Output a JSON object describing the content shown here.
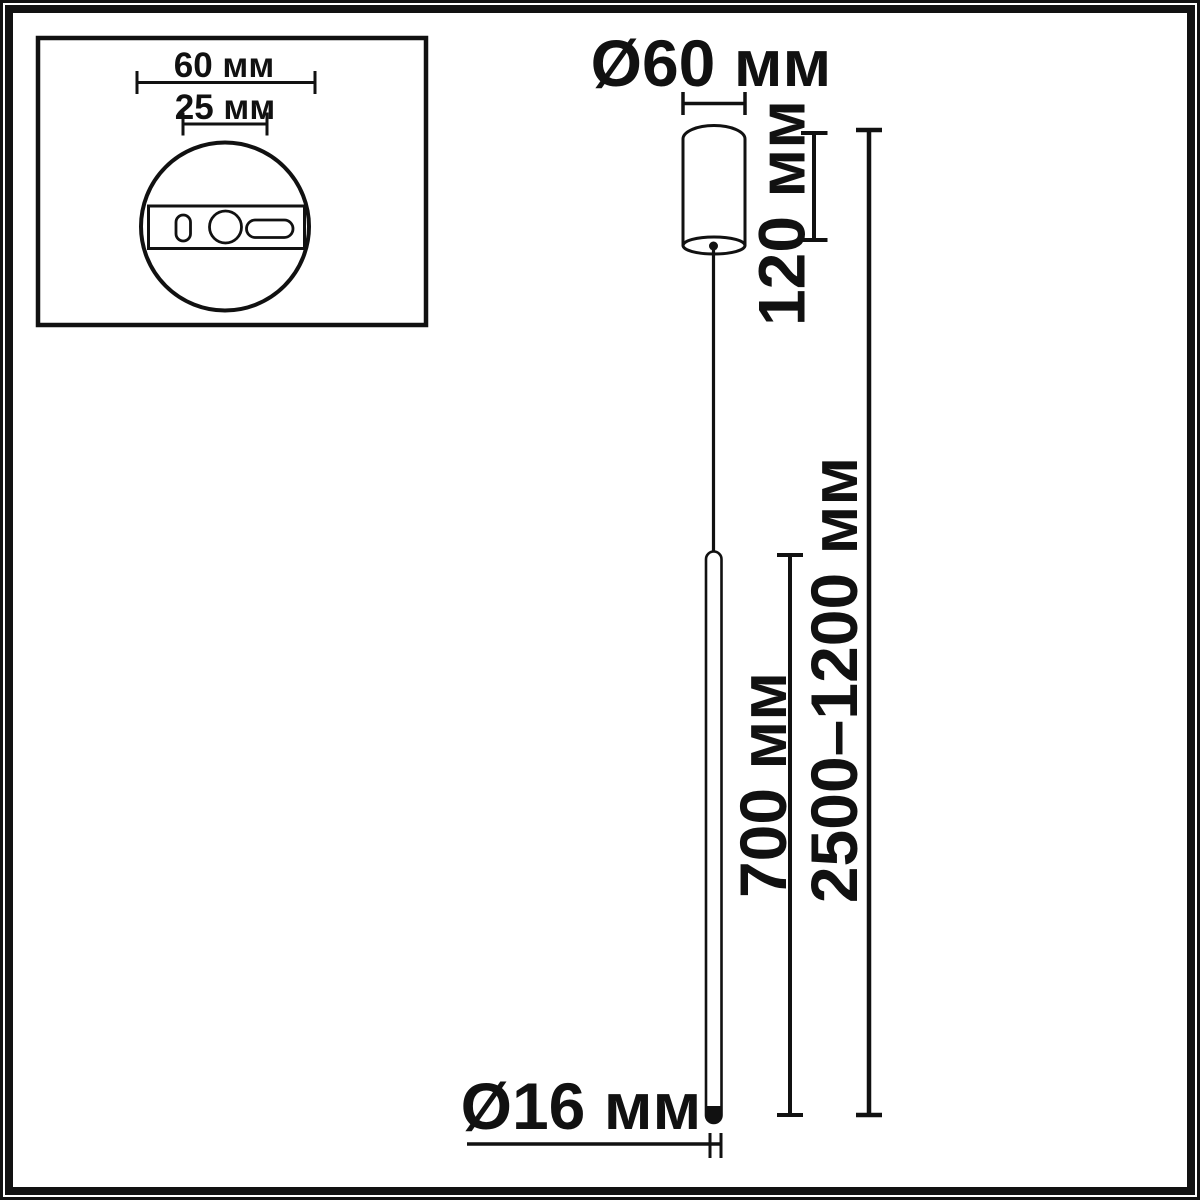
{
  "diagram": {
    "title": "pendant-lamp-dimension-drawing",
    "background_color": "#ffffff",
    "line_color": "#111111",
    "inset": {
      "plate_width_label": "60 мм",
      "hole_spacing_label": "25 мм"
    },
    "main": {
      "canopy_diameter_label": "Ø60 мм",
      "canopy_height_label": "120 мм",
      "rod_length_label": "700 мм",
      "suspension_height_label": "2500–1200 мм",
      "rod_diameter_label": "Ø16 мм"
    }
  }
}
